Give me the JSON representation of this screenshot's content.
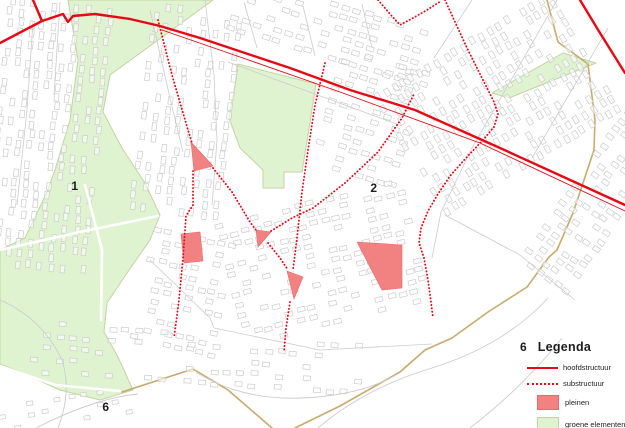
{
  "map": {
    "width": 625,
    "height": 428,
    "colors": {
      "red": "#e60915",
      "plein_fill": "#f28181",
      "plein_stroke": "#ea6a6a",
      "green_fill": "#e0f3d0",
      "green_border": "#c2d4a4",
      "boundary": "#c9aa6e",
      "base": "#cccccc",
      "label": "#1c1c1c"
    },
    "labels": [
      {
        "text": "1",
        "x": 75,
        "y": 186
      },
      {
        "text": "2",
        "x": 374,
        "y": 188
      },
      {
        "text": "6",
        "x": 106,
        "y": 407
      }
    ],
    "green_areas": [
      {
        "name": "park-west",
        "points": [
          [
            68,
            0
          ],
          [
            213,
            0
          ],
          [
            110,
            75
          ],
          [
            103,
            112
          ],
          [
            122,
            148
          ],
          [
            145,
            183
          ],
          [
            160,
            215
          ],
          [
            150,
            240
          ],
          [
            127,
            273
          ],
          [
            107,
            303
          ],
          [
            104,
            332
          ],
          [
            118,
            357
          ],
          [
            133,
            390
          ],
          [
            100,
            400
          ],
          [
            60,
            390
          ],
          [
            20,
            372
          ],
          [
            0,
            364
          ],
          [
            0,
            250
          ],
          [
            25,
            238
          ],
          [
            47,
            192
          ],
          [
            55,
            170
          ],
          [
            70,
            120
          ],
          [
            78,
            60
          ]
        ]
      },
      {
        "name": "green-block-center",
        "points": [
          [
            238,
            64
          ],
          [
            316,
            84
          ],
          [
            302,
            172
          ],
          [
            284,
            172
          ],
          [
            284,
            188
          ],
          [
            263,
            188
          ],
          [
            263,
            170
          ],
          [
            240,
            148
          ],
          [
            229,
            118
          ],
          [
            236,
            80
          ]
        ]
      },
      {
        "name": "green-band-northeast",
        "points": [
          [
            492,
            93
          ],
          [
            563,
            53
          ],
          [
            596,
            63
          ],
          [
            509,
            98
          ]
        ]
      }
    ],
    "pleinen": [
      {
        "name": "plein-triangle-1",
        "points": [
          [
            191,
            142
          ],
          [
            213,
            166
          ],
          [
            194,
            171
          ]
        ]
      },
      {
        "name": "plein-rect",
        "points": [
          [
            181,
            234
          ],
          [
            200,
            232
          ],
          [
            203,
            261
          ],
          [
            184,
            263
          ]
        ]
      },
      {
        "name": "plein-triangle-2",
        "points": [
          [
            256,
            230
          ],
          [
            271,
            232
          ],
          [
            258,
            247
          ]
        ]
      },
      {
        "name": "plein-triangle-3",
        "points": [
          [
            287,
            271
          ],
          [
            303,
            277
          ],
          [
            294,
            299
          ]
        ]
      },
      {
        "name": "plein-parallelogram",
        "points": [
          [
            357,
            242
          ],
          [
            402,
            245
          ],
          [
            402,
            288
          ],
          [
            382,
            290
          ]
        ]
      }
    ],
    "hoofdstructuur": [
      {
        "w": 2.4,
        "points": [
          [
            33,
            0
          ],
          [
            42,
            21
          ]
        ]
      },
      {
        "w": 2.4,
        "points": [
          [
            0,
            43
          ],
          [
            42,
            21
          ],
          [
            63,
            14
          ],
          [
            68,
            22
          ],
          [
            73,
            16
          ],
          [
            95,
            14
          ],
          [
            130,
            19
          ],
          [
            160,
            26
          ],
          [
            200,
            38
          ],
          [
            245,
            53
          ],
          [
            290,
            68
          ],
          [
            350,
            90
          ],
          [
            415,
            110
          ],
          [
            500,
            148
          ],
          [
            625,
            205
          ]
        ]
      },
      {
        "w": 2.4,
        "points": [
          [
            580,
            0
          ],
          [
            600,
            33
          ],
          [
            625,
            73
          ]
        ]
      },
      {
        "w": 0.9,
        "points": [
          [
            162,
            30
          ],
          [
            240,
            57
          ],
          [
            340,
            92
          ],
          [
            480,
            143
          ],
          [
            625,
            211
          ]
        ]
      }
    ],
    "substructuur": [
      [
        [
          158,
          20
        ],
        [
          172,
          75
        ],
        [
          188,
          130
        ],
        [
          192,
          143
        ]
      ],
      [
        [
          193,
          171
        ],
        [
          193,
          205
        ],
        [
          186,
          216
        ],
        [
          183,
          258
        ],
        [
          179,
          300
        ],
        [
          174,
          338
        ]
      ],
      [
        [
          213,
          168
        ],
        [
          232,
          192
        ],
        [
          250,
          222
        ],
        [
          256,
          230
        ]
      ],
      [
        [
          268,
          243
        ],
        [
          280,
          258
        ],
        [
          288,
          270
        ]
      ],
      [
        [
          325,
          63
        ],
        [
          315,
          105
        ],
        [
          308,
          150
        ],
        [
          302,
          192
        ],
        [
          297,
          238
        ],
        [
          293,
          270
        ]
      ],
      [
        [
          290,
          302
        ],
        [
          286,
          328
        ],
        [
          284,
          352
        ]
      ],
      [
        [
          271,
          231
        ],
        [
          292,
          218
        ],
        [
          313,
          208
        ],
        [
          345,
          183
        ],
        [
          378,
          152
        ],
        [
          402,
          118
        ],
        [
          414,
          94
        ]
      ],
      [
        [
          445,
          0
        ],
        [
          455,
          22
        ],
        [
          468,
          50
        ],
        [
          483,
          80
        ],
        [
          494,
          102
        ],
        [
          498,
          114
        ],
        [
          494,
          127
        ],
        [
          483,
          140
        ],
        [
          466,
          158
        ],
        [
          450,
          176
        ],
        [
          438,
          194
        ],
        [
          428,
          211
        ],
        [
          421,
          228
        ],
        [
          419,
          243
        ],
        [
          424,
          258
        ],
        [
          428,
          280
        ],
        [
          431,
          302
        ],
        [
          433,
          318
        ]
      ],
      [
        [
          378,
          0
        ],
        [
          390,
          14
        ],
        [
          400,
          25
        ],
        [
          413,
          18
        ],
        [
          427,
          10
        ],
        [
          441,
          1
        ]
      ]
    ],
    "boundary_lines": [
      [
        [
          547,
          0
        ],
        [
          558,
          42
        ],
        [
          588,
          64
        ],
        [
          595,
          120
        ],
        [
          594,
          150
        ],
        [
          573,
          213
        ],
        [
          557,
          250
        ],
        [
          549,
          257
        ],
        [
          527,
          287
        ],
        [
          488,
          312
        ],
        [
          452,
          338
        ],
        [
          425,
          350
        ],
        [
          400,
          372
        ],
        [
          340,
          406
        ],
        [
          295,
          428
        ]
      ],
      [
        [
          122,
          392
        ],
        [
          193,
          369
        ],
        [
          228,
          390
        ],
        [
          272,
          428
        ]
      ]
    ],
    "park_roads": [
      [
        [
          0,
          250
        ],
        [
          80,
          232
        ],
        [
          158,
          216
        ]
      ],
      [
        [
          0,
          366
        ],
        [
          55,
          385
        ],
        [
          120,
          391
        ]
      ],
      [
        [
          85,
          185
        ],
        [
          102,
          250
        ],
        [
          101,
          320
        ]
      ]
    ],
    "streets": [
      [
        [
          33,
          22
        ],
        [
          27,
          110
        ],
        [
          17,
          205
        ]
      ],
      [
        [
          60,
          2
        ],
        [
          54,
          95
        ]
      ],
      [
        [
          150,
          10
        ],
        [
          170,
          98
        ],
        [
          183,
          152
        ]
      ],
      [
        [
          205,
          0
        ],
        [
          214,
          75
        ],
        [
          217,
          140
        ],
        [
          212,
          205
        ]
      ],
      [
        [
          228,
          62
        ],
        [
          402,
          126
        ]
      ],
      [
        [
          244,
          2
        ],
        [
          257,
          48
        ]
      ],
      [
        [
          303,
          6
        ],
        [
          315,
          56
        ]
      ],
      [
        [
          362,
          4
        ],
        [
          372,
          48
        ]
      ],
      [
        [
          557,
          0
        ],
        [
          472,
          148
        ],
        [
          441,
          212
        ],
        [
          432,
          258
        ]
      ],
      [
        [
          608,
          28
        ],
        [
          532,
          158
        ]
      ],
      [
        [
          472,
          0
        ],
        [
          434,
          58
        ]
      ],
      [
        [
          214,
          328
        ],
        [
          320,
          350
        ],
        [
          432,
          344
        ]
      ],
      [
        [
          150,
          260
        ],
        [
          210,
          318
        ],
        [
          214,
          328
        ]
      ],
      [
        [
          445,
          215
        ],
        [
          520,
          255
        ],
        [
          575,
          300
        ]
      ]
    ],
    "curved_roads": [
      "M0,300 Q42,318 62,360 Q72,392 58,428",
      "M318,428 Q365,388 432,368 Q505,345 548,298",
      "M470,428 Q522,388 562,338",
      "M36,428 Q95,398 138,394",
      "M196,372 Q240,400 300,398 Q360,396 398,374"
    ],
    "districts": [
      {
        "x": -4,
        "y": 2,
        "w": 100,
        "h": 262,
        "rot": 6,
        "bw": 4.5,
        "bh": 7.5,
        "gx": 11,
        "gy": 10,
        "skip": 0.3
      },
      {
        "x": 142,
        "y": 8,
        "w": 92,
        "h": 210,
        "rot": 7,
        "bw": 4.5,
        "bh": 7.5,
        "gx": 12,
        "gy": 10,
        "skip": 0.35
      },
      {
        "x": 232,
        "y": 0,
        "w": 185,
        "h": 56,
        "rot": 17,
        "bw": 7.5,
        "bh": 4.5,
        "gx": 11.5,
        "gy": 10.5,
        "skip": 0.35
      },
      {
        "x": 326,
        "y": 58,
        "w": 92,
        "h": 118,
        "rot": 17,
        "bw": 7.5,
        "bh": 4.5,
        "gx": 11.5,
        "gy": 10.5,
        "skip": 0.35
      },
      {
        "x": 425,
        "y": 0,
        "w": 140,
        "h": 210,
        "rot": 59,
        "bw": 7.5,
        "bh": 4.5,
        "gx": 11,
        "gy": 10,
        "skip": 0.35
      },
      {
        "x": 565,
        "y": 110,
        "w": 62,
        "h": 190,
        "rot": 35,
        "bw": 7,
        "bh": 4.5,
        "gx": 10.5,
        "gy": 10,
        "skip": 0.3
      },
      {
        "x": 228,
        "y": 200,
        "w": 195,
        "h": 125,
        "rot": -14,
        "bw": 7.5,
        "bh": 4.5,
        "gx": 11.5,
        "gy": 10,
        "skip": 0.4
      },
      {
        "x": 142,
        "y": 235,
        "w": 85,
        "h": 115,
        "rot": 12,
        "bw": 7,
        "bh": 4.5,
        "gx": 11,
        "gy": 10,
        "skip": 0.4
      },
      {
        "x": 30,
        "y": 332,
        "w": 330,
        "h": 52,
        "rot": 4,
        "bw": 7,
        "bh": 4.5,
        "gx": 13,
        "gy": 12,
        "skip": 0.55
      },
      {
        "x": 0,
        "y": 395,
        "w": 150,
        "h": 33,
        "rot": -8,
        "bw": 6,
        "bh": 4,
        "gx": 14,
        "gy": 11,
        "skip": 0.6
      }
    ]
  },
  "legend": {
    "number": "6",
    "title": "Legenda",
    "items": [
      {
        "label": "hoofdstructuur"
      },
      {
        "label": "substructuur"
      },
      {
        "label": "pleinen"
      },
      {
        "label": "groene elementen"
      }
    ]
  }
}
